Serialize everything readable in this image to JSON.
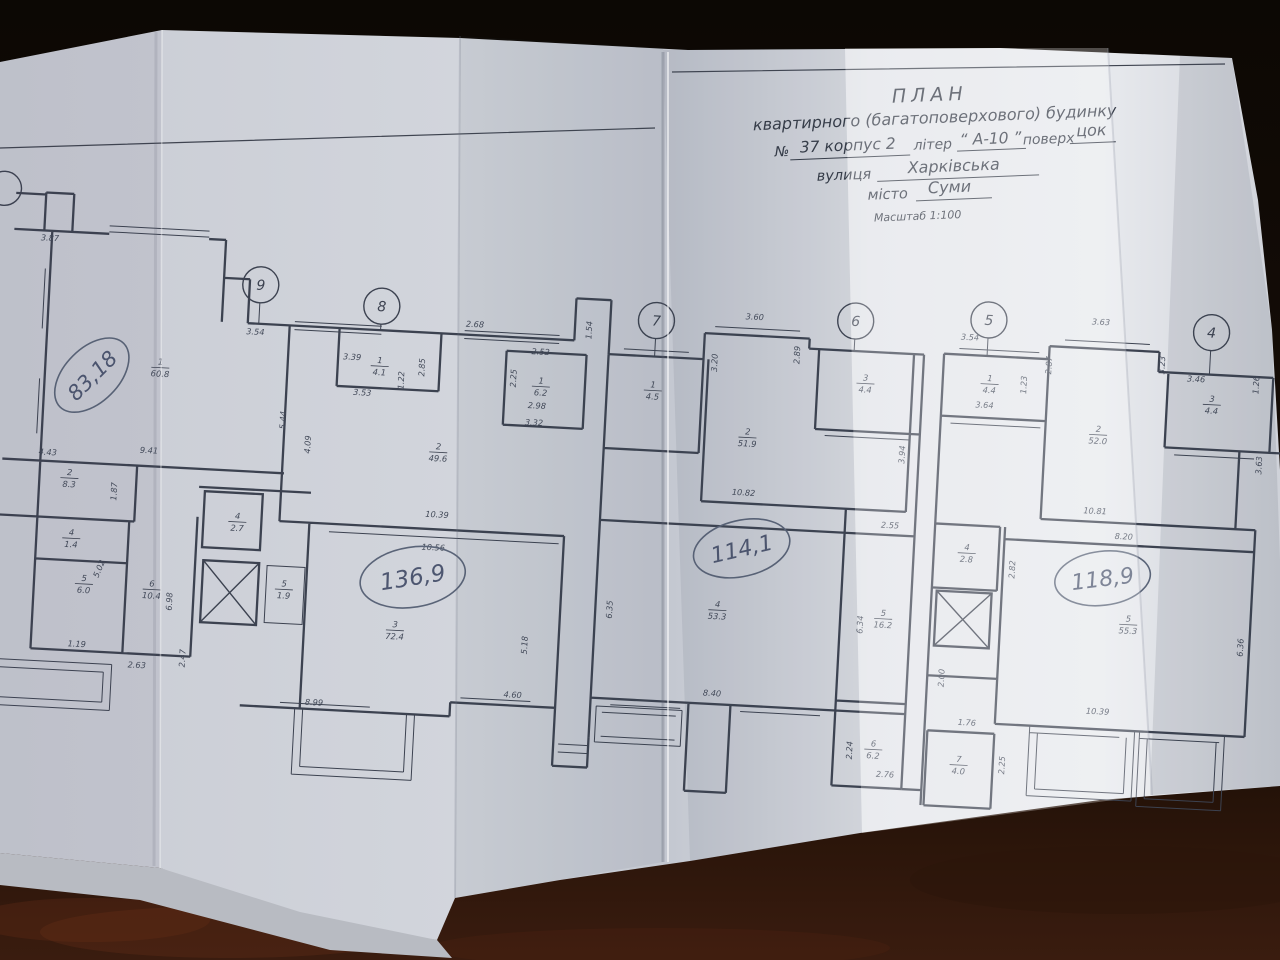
{
  "header": {
    "title": "ПЛАН",
    "subtitle": "квартирного (багатоповерхового) будинку",
    "no_label": "№",
    "no_value": "37 корпус 2",
    "liter_label": "літер",
    "liter_value": "“ А-10 ”",
    "floor_label": "поверх",
    "floor_value": "цок",
    "street_label": "вулиця",
    "street_value": "Харківська",
    "city_label": "місто",
    "city_value": "Суми",
    "scale": "Масштаб 1:100"
  },
  "axes": [
    "9",
    "8",
    "7",
    "6",
    "5",
    "4"
  ],
  "totals": [
    "83,18",
    "136,9",
    "114,1",
    "118,9"
  ],
  "rooms": [
    {
      "n": "1",
      "a": "60.8"
    },
    {
      "n": "2",
      "a": "8.3"
    },
    {
      "n": "4",
      "a": "1.4"
    },
    {
      "n": "5",
      "a": "6.0"
    },
    {
      "n": "6",
      "a": "10.4"
    },
    {
      "n": "2",
      "a": "49.6"
    },
    {
      "n": "1",
      "a": "4.1"
    },
    {
      "n": "1",
      "a": "6.2"
    },
    {
      "n": "4",
      "a": "2.7"
    },
    {
      "n": "5",
      "a": "1.9"
    },
    {
      "n": "3",
      "a": "72.4"
    },
    {
      "n": "1",
      "a": "4.5"
    },
    {
      "n": "2",
      "a": "51.9"
    },
    {
      "n": "3",
      "a": "4.4"
    },
    {
      "n": "4",
      "a": "53.3"
    },
    {
      "n": "5",
      "a": "16.2"
    },
    {
      "n": "6",
      "a": "6.2"
    },
    {
      "n": "1",
      "a": "4.4"
    },
    {
      "n": "2",
      "a": "52.0"
    },
    {
      "n": "3",
      "a": "4.4"
    },
    {
      "n": "4",
      "a": "2.8"
    },
    {
      "n": "5",
      "a": "55.3"
    },
    {
      "n": "7",
      "a": "4.0"
    }
  ],
  "dims": [
    "3.87",
    "3.54",
    "1.54",
    "3.39",
    "3.53",
    "1.22",
    "2.85",
    "2.68",
    "2.52",
    "2.25",
    "2.98",
    "3.32",
    "5.44",
    "4.09",
    "4.43",
    "9.41",
    "1.87",
    "5.02",
    "1.19",
    "2.63",
    "6.98",
    "2.47",
    "10.39",
    "10.56",
    "5.18",
    "4.60",
    "8.99",
    "3.60",
    "3.20",
    "2.89",
    "10.82",
    "3.94",
    "2.55",
    "6.35",
    "6.34",
    "8.40",
    "2.24",
    "2.76",
    "3.54",
    "3.64",
    "1.23",
    "2.87",
    "3.63",
    "3.23",
    "3.46",
    "1.26",
    "3.63",
    "10.81",
    "8.20",
    "2.82",
    "2.00",
    "10.39",
    "6.36",
    "1.76",
    "2.25"
  ]
}
